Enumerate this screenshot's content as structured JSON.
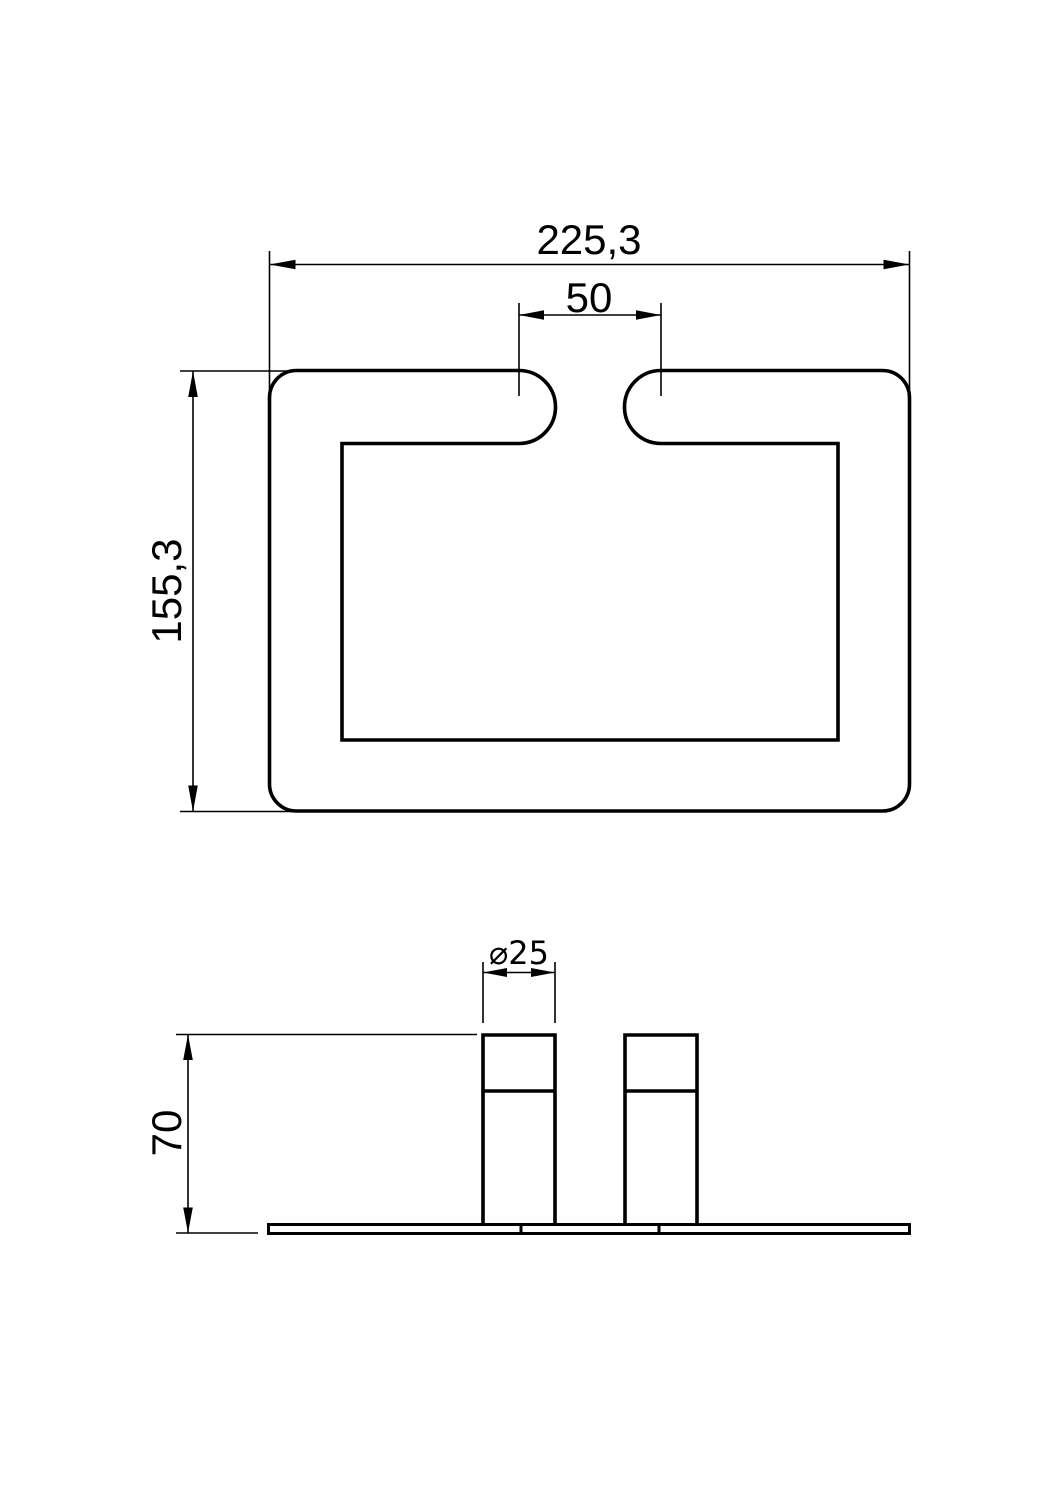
{
  "drawing": {
    "colors": {
      "background": "#ffffff",
      "line": "#000000"
    },
    "top_view": {
      "width_dim": "225,3",
      "slot_dim": "50",
      "height_dim": "155,3"
    },
    "front_view": {
      "diameter_dim": "⌀25",
      "height_dim": "70"
    }
  }
}
